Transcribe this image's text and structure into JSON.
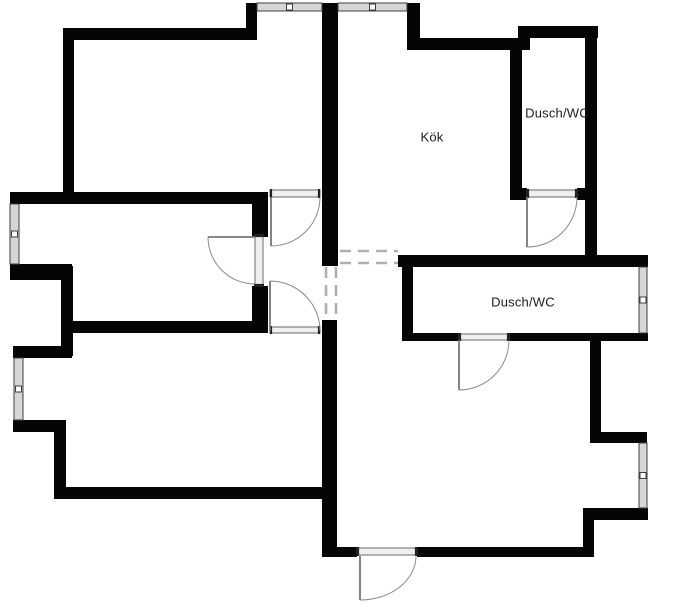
{
  "page": {
    "background": "#ffffff"
  },
  "labels": {
    "kok": {
      "text": "Kök",
      "x": 432,
      "y": 137
    },
    "dusch_top": {
      "text": "Dusch/WC",
      "x": 557,
      "y": 113
    },
    "dusch_mid": {
      "text": "Dusch/WC",
      "x": 523,
      "y": 302
    }
  },
  "style": {
    "wall_color": "#050505",
    "window_fill": "#d6d6d6",
    "window_stroke": "#3f3f3f",
    "sill_fill": "#efefef",
    "sill_stroke": "#5a5a5a",
    "arc_color": "#8a8a8a",
    "leaf_color": "#777777",
    "dash_color": "#b0b0b0",
    "text_color": "#1a1a1a"
  },
  "floorplan": {
    "canvas": {
      "width": 700,
      "height": 607
    },
    "walls": [
      [
        63,
        28,
        194,
        12
      ],
      [
        63,
        28,
        11,
        169
      ],
      [
        246,
        3,
        11,
        37
      ],
      [
        322,
        3,
        16,
        263
      ],
      [
        407,
        3,
        13,
        47
      ],
      [
        412,
        38,
        118,
        12
      ],
      [
        518,
        26,
        80,
        12
      ],
      [
        518,
        26,
        12,
        24
      ],
      [
        510,
        50,
        12,
        150
      ],
      [
        585,
        26,
        12,
        241
      ],
      [
        510,
        188,
        17,
        12
      ],
      [
        577,
        188,
        20,
        12
      ],
      [
        10,
        192,
        255,
        12
      ],
      [
        10,
        264,
        62,
        16
      ],
      [
        61,
        266,
        12,
        90
      ],
      [
        13,
        346,
        59,
        12
      ],
      [
        13,
        420,
        52,
        12
      ],
      [
        54,
        420,
        12,
        79
      ],
      [
        54,
        487,
        278,
        12
      ],
      [
        63,
        321,
        202,
        12
      ],
      [
        252,
        192,
        16,
        45
      ],
      [
        252,
        286,
        16,
        47
      ],
      [
        322,
        320,
        15,
        237
      ],
      [
        398,
        255,
        250,
        12
      ],
      [
        402,
        267,
        11,
        74
      ],
      [
        402,
        333,
        57,
        8
      ],
      [
        509,
        333,
        139,
        8
      ],
      [
        590,
        341,
        11,
        102
      ],
      [
        590,
        432,
        57,
        11
      ],
      [
        583,
        508,
        65,
        12
      ],
      [
        583,
        508,
        11,
        49
      ],
      [
        322,
        547,
        35,
        10
      ],
      [
        417,
        547,
        177,
        10
      ]
    ],
    "windows": [
      {
        "x": 257,
        "y": 3,
        "w": 65,
        "h": 8,
        "dir": "h"
      },
      {
        "x": 338,
        "y": 3,
        "w": 69,
        "h": 8,
        "dir": "h"
      },
      {
        "x": 10,
        "y": 204,
        "w": 9,
        "h": 60,
        "dir": "v"
      },
      {
        "x": 14,
        "y": 358,
        "w": 9,
        "h": 62,
        "dir": "v"
      },
      {
        "x": 639,
        "y": 267,
        "w": 8,
        "h": 66,
        "dir": "v"
      },
      {
        "x": 639,
        "y": 443,
        "w": 8,
        "h": 65,
        "dir": "v"
      }
    ],
    "sills": [
      {
        "x": 527,
        "y": 190,
        "w": 50,
        "h": 7
      },
      {
        "x": 270,
        "y": 190,
        "w": 50,
        "h": 7
      },
      {
        "x": 255,
        "y": 235,
        "w": 8,
        "h": 51
      },
      {
        "x": 270,
        "y": 327,
        "w": 50,
        "h": 6
      },
      {
        "x": 459,
        "y": 334,
        "w": 50,
        "h": 6
      },
      {
        "x": 357,
        "y": 548,
        "w": 60,
        "h": 7
      }
    ],
    "doors": [
      {
        "arc": "M577,197 A50,50 0 0 1 527,247",
        "leaf": [
          527,
          197,
          527,
          247
        ]
      },
      {
        "arc": "M320,197 A49,49 0 0 1 271,246",
        "leaf": [
          271,
          197,
          271,
          246
        ]
      },
      {
        "arc": "M208,237 A47,47 0 0 0 255,284",
        "leaf": [
          208,
          237,
          255,
          237
        ]
      },
      {
        "arc": "M270,281 A50,50 0 0 1 320,331",
        "leaf": [
          270,
          281,
          270,
          331
        ]
      },
      {
        "arc": "M509,340 A50,50 0 0 1 459,390",
        "leaf": [
          459,
          340,
          459,
          390
        ]
      },
      {
        "arc": "M416,557 A56,44 0 0 1 360,600",
        "leaf": [
          360,
          556,
          360,
          600
        ]
      }
    ],
    "dashed_openings": [
      [
        340,
        251,
        398,
        251
      ],
      [
        340,
        263,
        398,
        263
      ],
      [
        326,
        267,
        326,
        320
      ],
      [
        336,
        267,
        336,
        320
      ]
    ]
  }
}
